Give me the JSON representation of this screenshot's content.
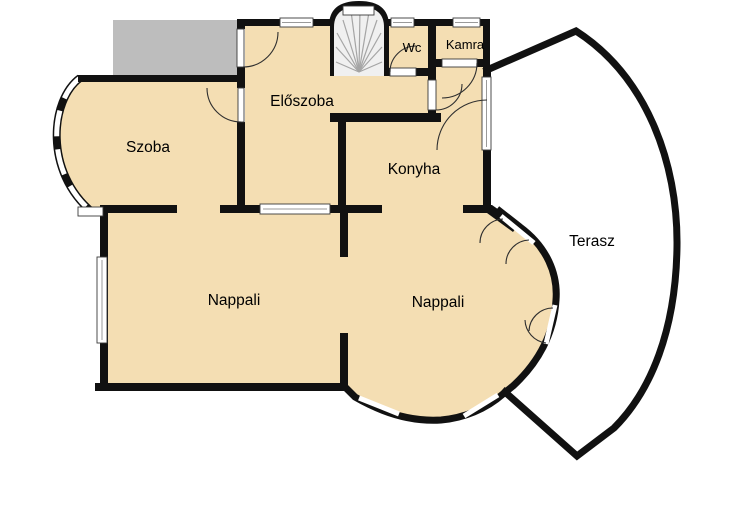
{
  "plan": {
    "title": "Floor plan",
    "rooms": [
      {
        "id": "szoba",
        "label": "Szoba"
      },
      {
        "id": "eloszoba",
        "label": "Előszoba"
      },
      {
        "id": "wc",
        "label": "Wc"
      },
      {
        "id": "kamra",
        "label": "Kamra"
      },
      {
        "id": "konyha",
        "label": "Konyha"
      },
      {
        "id": "nappali-left",
        "label": "Nappali"
      },
      {
        "id": "nappali-right",
        "label": "Nappali"
      },
      {
        "id": "terasz",
        "label": "Terasz"
      }
    ],
    "colors": {
      "room_fill": "#F4DEB3",
      "wall": "#111111",
      "gray_area": "#BDBDBD",
      "stair_fill": "#F0F0F0",
      "window_white": "#FFFFFF"
    }
  }
}
